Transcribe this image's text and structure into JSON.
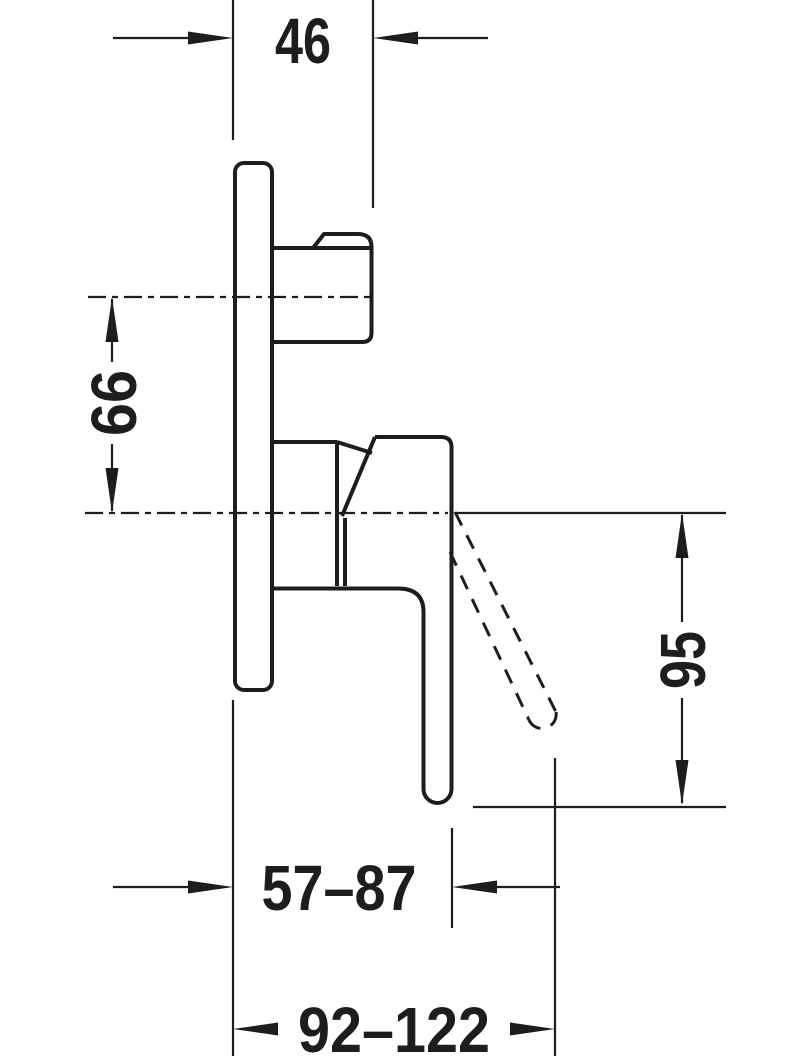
{
  "drawing": {
    "colors": {
      "line": "#1d1d1b",
      "background": "#ffffff"
    },
    "dimensions": {
      "top_width": "46",
      "upper_center_offset": "66",
      "lever_drop_height": "95",
      "wall_to_lever_depth": "57–87",
      "wall_to_lever_max_depth": "92–122"
    }
  }
}
